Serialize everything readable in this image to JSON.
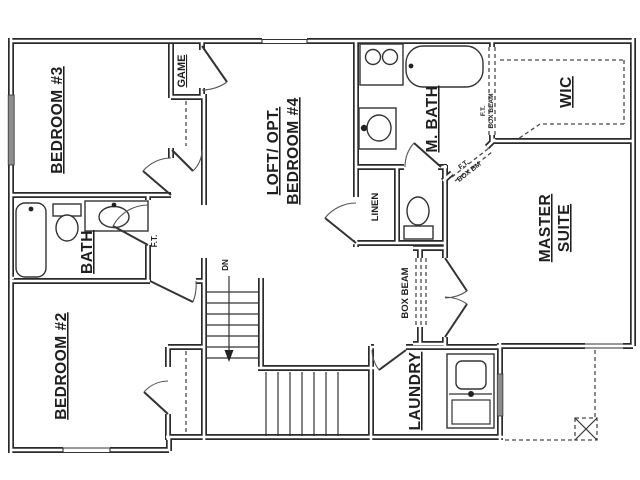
{
  "plan": {
    "title": "second-floor-plan",
    "labels": {
      "bedroom3": "BEDROOM #3",
      "bedroom2": "BEDROOM #2",
      "bath": "BATH",
      "game": "GAME",
      "loft1": "LOFT/ OPT.",
      "loft2": "BEDROOM #4",
      "mbath": "M. BATH",
      "wic": "WIC",
      "linen": "LINEN",
      "master1": "MASTER",
      "master2": "SUITE",
      "laundry": "LAUNDRY",
      "dn": "DN",
      "ft_hall": "F.T.",
      "box_beam_center": "BOX BEAM",
      "ft_wic": "F.T.",
      "box_beam_wic": "BOX BEAM",
      "ft_diag": "F.T.",
      "box_bm_diag": "BOX BM"
    },
    "colors": {
      "wall_line": "#2a2a2a",
      "window_fill": "#8c8c8c",
      "background": "#ffffff",
      "text": "#1f1f1f"
    }
  }
}
